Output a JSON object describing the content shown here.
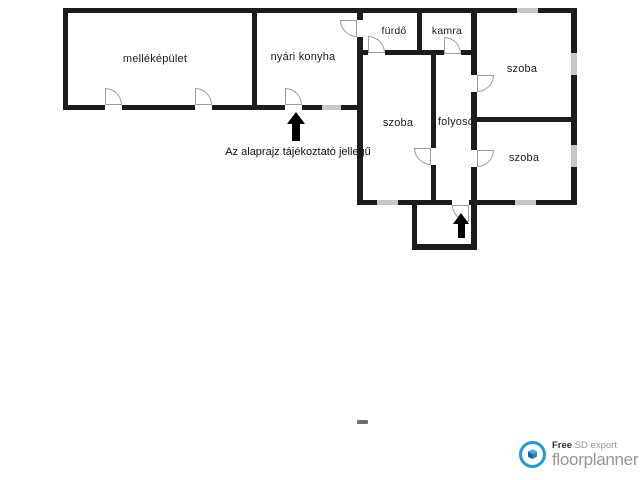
{
  "floorplan": {
    "rooms": [
      {
        "id": "mellekepulet",
        "label": "melléképület"
      },
      {
        "id": "nyari-konyha",
        "label": "nyári konyha"
      },
      {
        "id": "furdo",
        "label": "fürdő"
      },
      {
        "id": "kamra",
        "label": "kamra"
      },
      {
        "id": "szoba-top-right",
        "label": "szoba"
      },
      {
        "id": "szoba-middle",
        "label": "szoba"
      },
      {
        "id": "folyoso",
        "label": "folyosó"
      },
      {
        "id": "szoba-bottom-right",
        "label": "szoba"
      }
    ],
    "disclaimer": "Az alaprajz tájékoztató jellegű",
    "colors": {
      "wall": "#1c1c1c",
      "window": "#c6c6c6",
      "door": "#9e9e9e",
      "arrow": "#000000"
    }
  },
  "footer": {
    "free_label": "Free",
    "export_label": "SD export",
    "brand": "floorplanner",
    "brand_color": "#1e9cd7"
  }
}
